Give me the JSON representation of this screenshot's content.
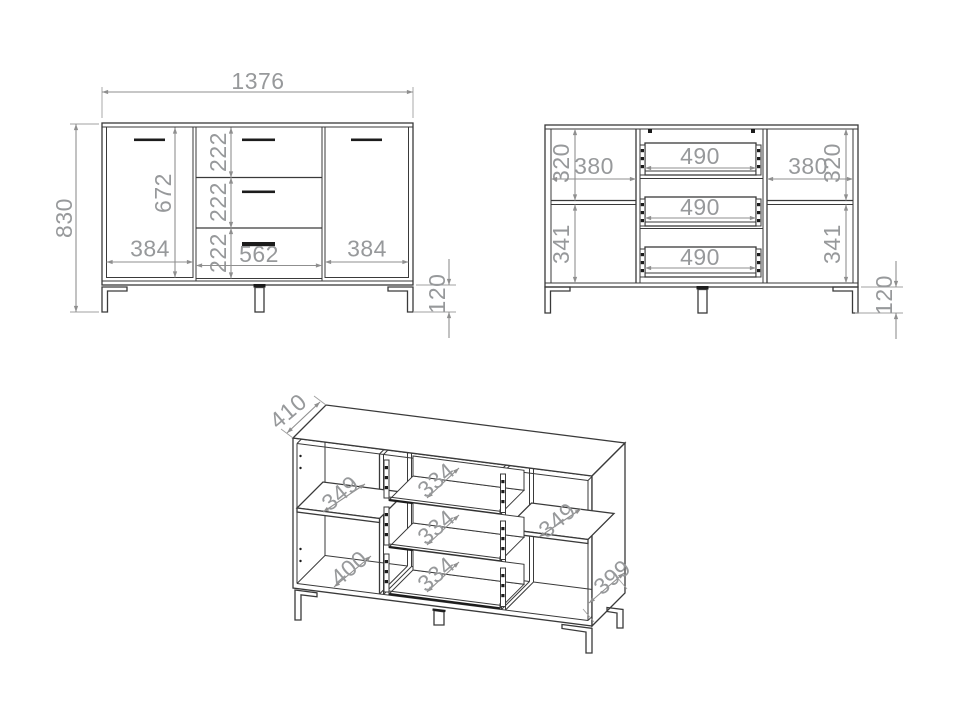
{
  "page": {
    "background": "#ffffff",
    "line_color": "#3a3a3a",
    "dimension_color": "#8f8f8f",
    "text_color": "#97999b"
  },
  "views": {
    "front": {
      "overall_width": "1376",
      "overall_height": "830",
      "door_height": "672",
      "drawer_front_heights": [
        "222",
        "222",
        "222"
      ],
      "left_door_width": "384",
      "drawer_section_width": "562",
      "right_door_width": "384",
      "leg_height": "120"
    },
    "internal": {
      "left_compartment_width": "380",
      "left_upper_height": "320",
      "left_lower_height": "341",
      "drawer_box_widths": [
        "490",
        "490",
        "490"
      ],
      "right_compartment_width": "380",
      "right_upper_height": "320",
      "right_lower_height": "341",
      "leg_height": "120"
    },
    "perspective": {
      "top_depth": "410",
      "left_shelf_depth": "349",
      "left_bottom_depth": "400",
      "drawer_depths": [
        "334",
        "334",
        "334"
      ],
      "right_shelf_depth": "349",
      "side_depth": "399"
    }
  }
}
